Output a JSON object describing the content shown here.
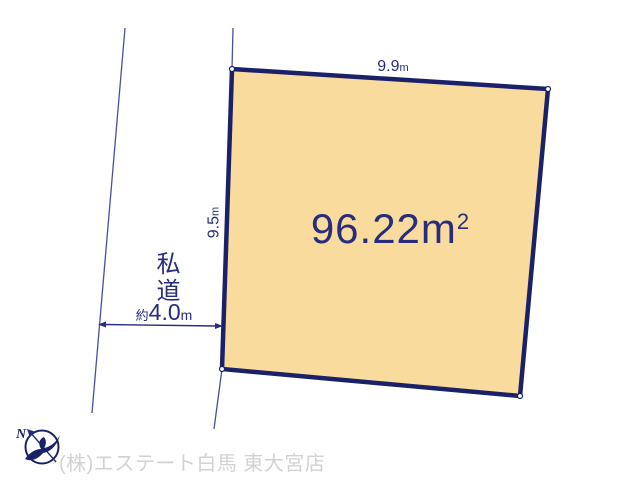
{
  "colors": {
    "navy_text": "#272c7d",
    "line_blue": "#4a4f9b",
    "plot_fill": "#f8db9d",
    "plot_border": "#1b2168",
    "footer_gray": "#d2d2d2"
  },
  "plot": {
    "area": {
      "value": "96.22",
      "unit": "m",
      "exponent": "2"
    },
    "dimensions": {
      "top": {
        "value": "9.9",
        "unit": "m"
      },
      "left": {
        "value": "9.5",
        "unit": "m"
      }
    }
  },
  "road": {
    "name": "私道",
    "width": {
      "prefix": "約",
      "value": "4.0",
      "unit": "m"
    }
  },
  "compass": {
    "north": "N"
  },
  "footer": {
    "company": "(株)エステート白馬 東大宮店"
  }
}
